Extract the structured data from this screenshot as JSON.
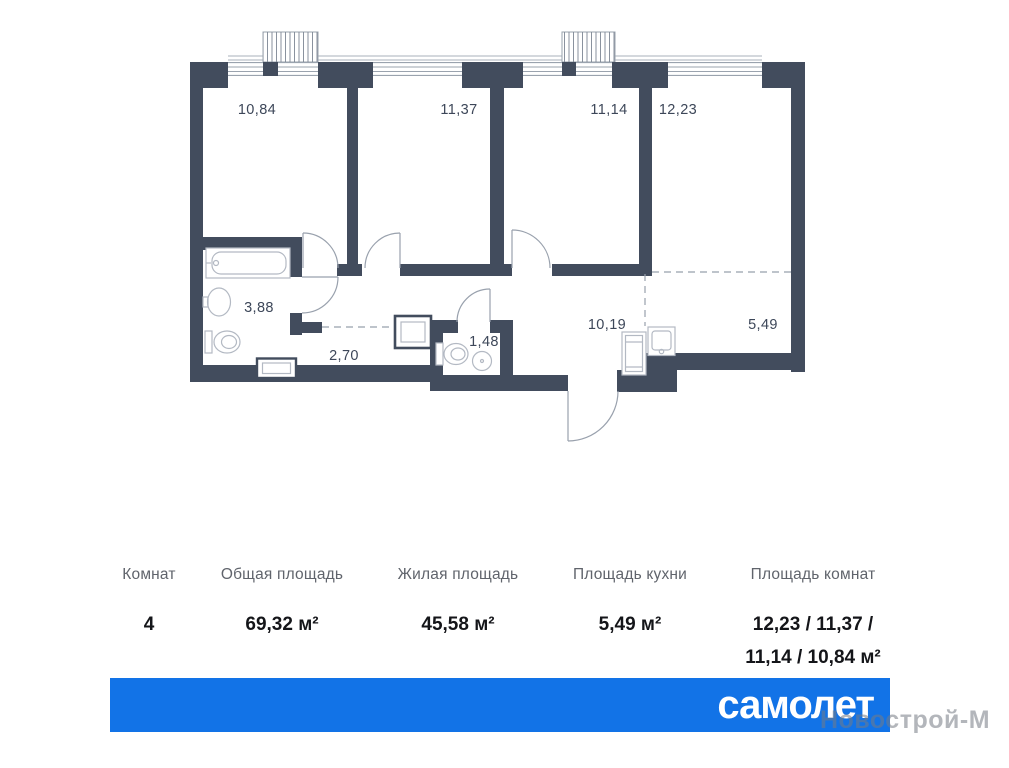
{
  "plan": {
    "rooms": [
      {
        "name": "bedroom-1",
        "area": "10,84"
      },
      {
        "name": "bedroom-2",
        "area": "11,37"
      },
      {
        "name": "bedroom-3",
        "area": "11,14"
      },
      {
        "name": "living-room",
        "area": "12,23"
      },
      {
        "name": "bathroom",
        "area": "3,88"
      },
      {
        "name": "corridor",
        "area": "2,70"
      },
      {
        "name": "wc",
        "area": "1,48"
      },
      {
        "name": "hallway",
        "area": "10,19"
      },
      {
        "name": "kitchen",
        "area": "5,49"
      }
    ]
  },
  "summary": {
    "columns": [
      {
        "label": "Комнат",
        "value": "4"
      },
      {
        "label": "Общая площадь",
        "value": "69,32 м²"
      },
      {
        "label": "Жилая площадь",
        "value": "45,58 м²"
      },
      {
        "label": "Площадь кухни",
        "value": "5,49 м²"
      },
      {
        "label": "Площадь комнат",
        "value_line1": "12,23 / 11,37 /",
        "value_line2": "11,14 / 10,84 м²"
      }
    ]
  },
  "footer": {
    "brand": "самолет",
    "watermark": "Новострой-М"
  },
  "colors": {
    "wall": "#424c5d",
    "brand_blue": "#1273e7",
    "room_label": "#3d4759",
    "table_header": "#60646c",
    "table_value": "#141519",
    "watermark": "rgba(116,122,132,0.55)"
  }
}
